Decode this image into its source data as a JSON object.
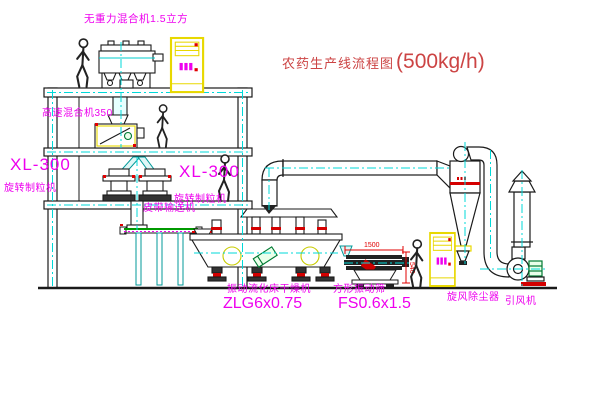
{
  "title": {
    "name": "农药生产线流程图",
    "capacity": "(500kg/h)"
  },
  "equipment_labels": {
    "zero_gravity_mixer": "无重力混合机1.5立方",
    "high_speed_mixer": "高速混合机350",
    "granulator_left": {
      "model": "XL-300",
      "name": "旋转制粒机"
    },
    "granulator_right": {
      "model": "XL-300",
      "name": "旋转制粒机"
    },
    "belt_conveyor": "皮带输送机",
    "fluid_bed_dryer": {
      "name": "振动流化床干燥机",
      "model": "ZLG6x0.75"
    },
    "vibrating_screen": {
      "name": "方形振动筛",
      "model": "FS0.6x1.5"
    },
    "cyclone": "旋风除尘器",
    "induced_draft_fan": "引风机"
  },
  "dimensions": {
    "screen_length": "1500",
    "screen_height": "540"
  },
  "colors": {
    "label_magenta": "#ee00ee",
    "title_red": "#cc4444",
    "dimension_red": "#e00000",
    "centerline_cyan": "#00d9d9",
    "cabinet_yellow": "#e8d800",
    "belt_green": "#009900",
    "motor_green": "#007a33",
    "drawing_line": "#1a1a1a",
    "background": "#ffffff"
  }
}
